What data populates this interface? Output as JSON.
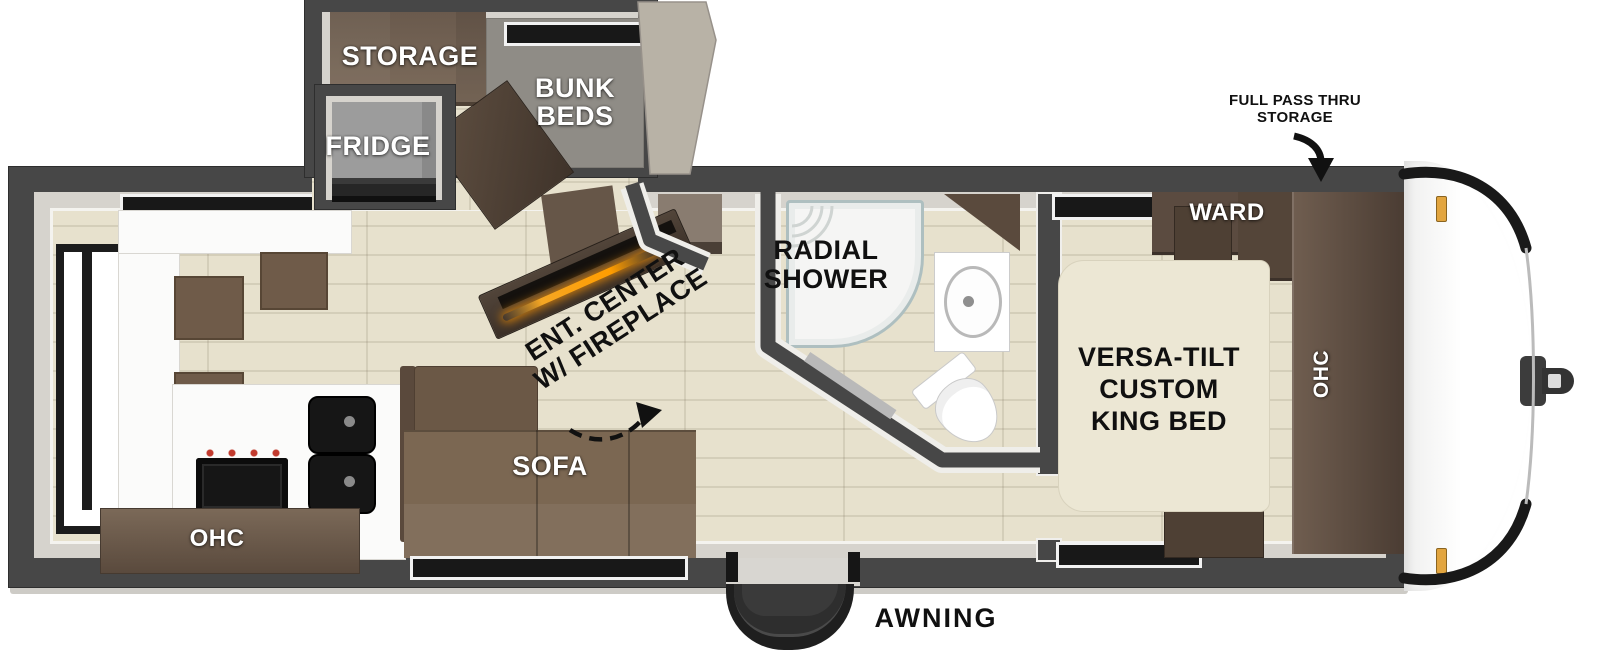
{
  "labels": {
    "storage": "STORAGE",
    "bunk1": "BUNK",
    "bunk2": "BEDS",
    "fridge": "FRIDGE",
    "radial1": "RADIAL",
    "radial2": "SHOWER",
    "ent1": "ENT. CENTER",
    "ent2": "W/ FIREPLACE",
    "sofa": "SOFA",
    "ohc_kitchen": "OHC",
    "ward": "WARD",
    "ohc_front": "OHC",
    "bed1": "VERSA-TILT",
    "bed2": "CUSTOM",
    "bed3": "KING BED",
    "awning": "AWNING",
    "pass1": "FULL PASS THRU",
    "pass2": "STORAGE"
  },
  "colors": {
    "wall": "#474747",
    "wallDark": "#2e2e2e",
    "lining": "#d6d3cd",
    "floor": "#e7e1cd",
    "plank": "rgba(115,104,82,0.16)",
    "carpet": "#8f8c86",
    "counter": "#fbfbfa",
    "brown": "#6f5b49",
    "brownDark": "#57473a",
    "brownDeep": "#3d3128",
    "sofa": "#7b6752",
    "sofaDark": "#5a493c",
    "bed": "#ece7d4",
    "fridgeGray": "#9c9c9c",
    "applianceBlack": "#161616",
    "knobRed": "#c23b2e",
    "markerAmber": "#e2a53f",
    "fireplaceGlow": "#ff9d00",
    "showerTrim": "#aebfc0"
  }
}
